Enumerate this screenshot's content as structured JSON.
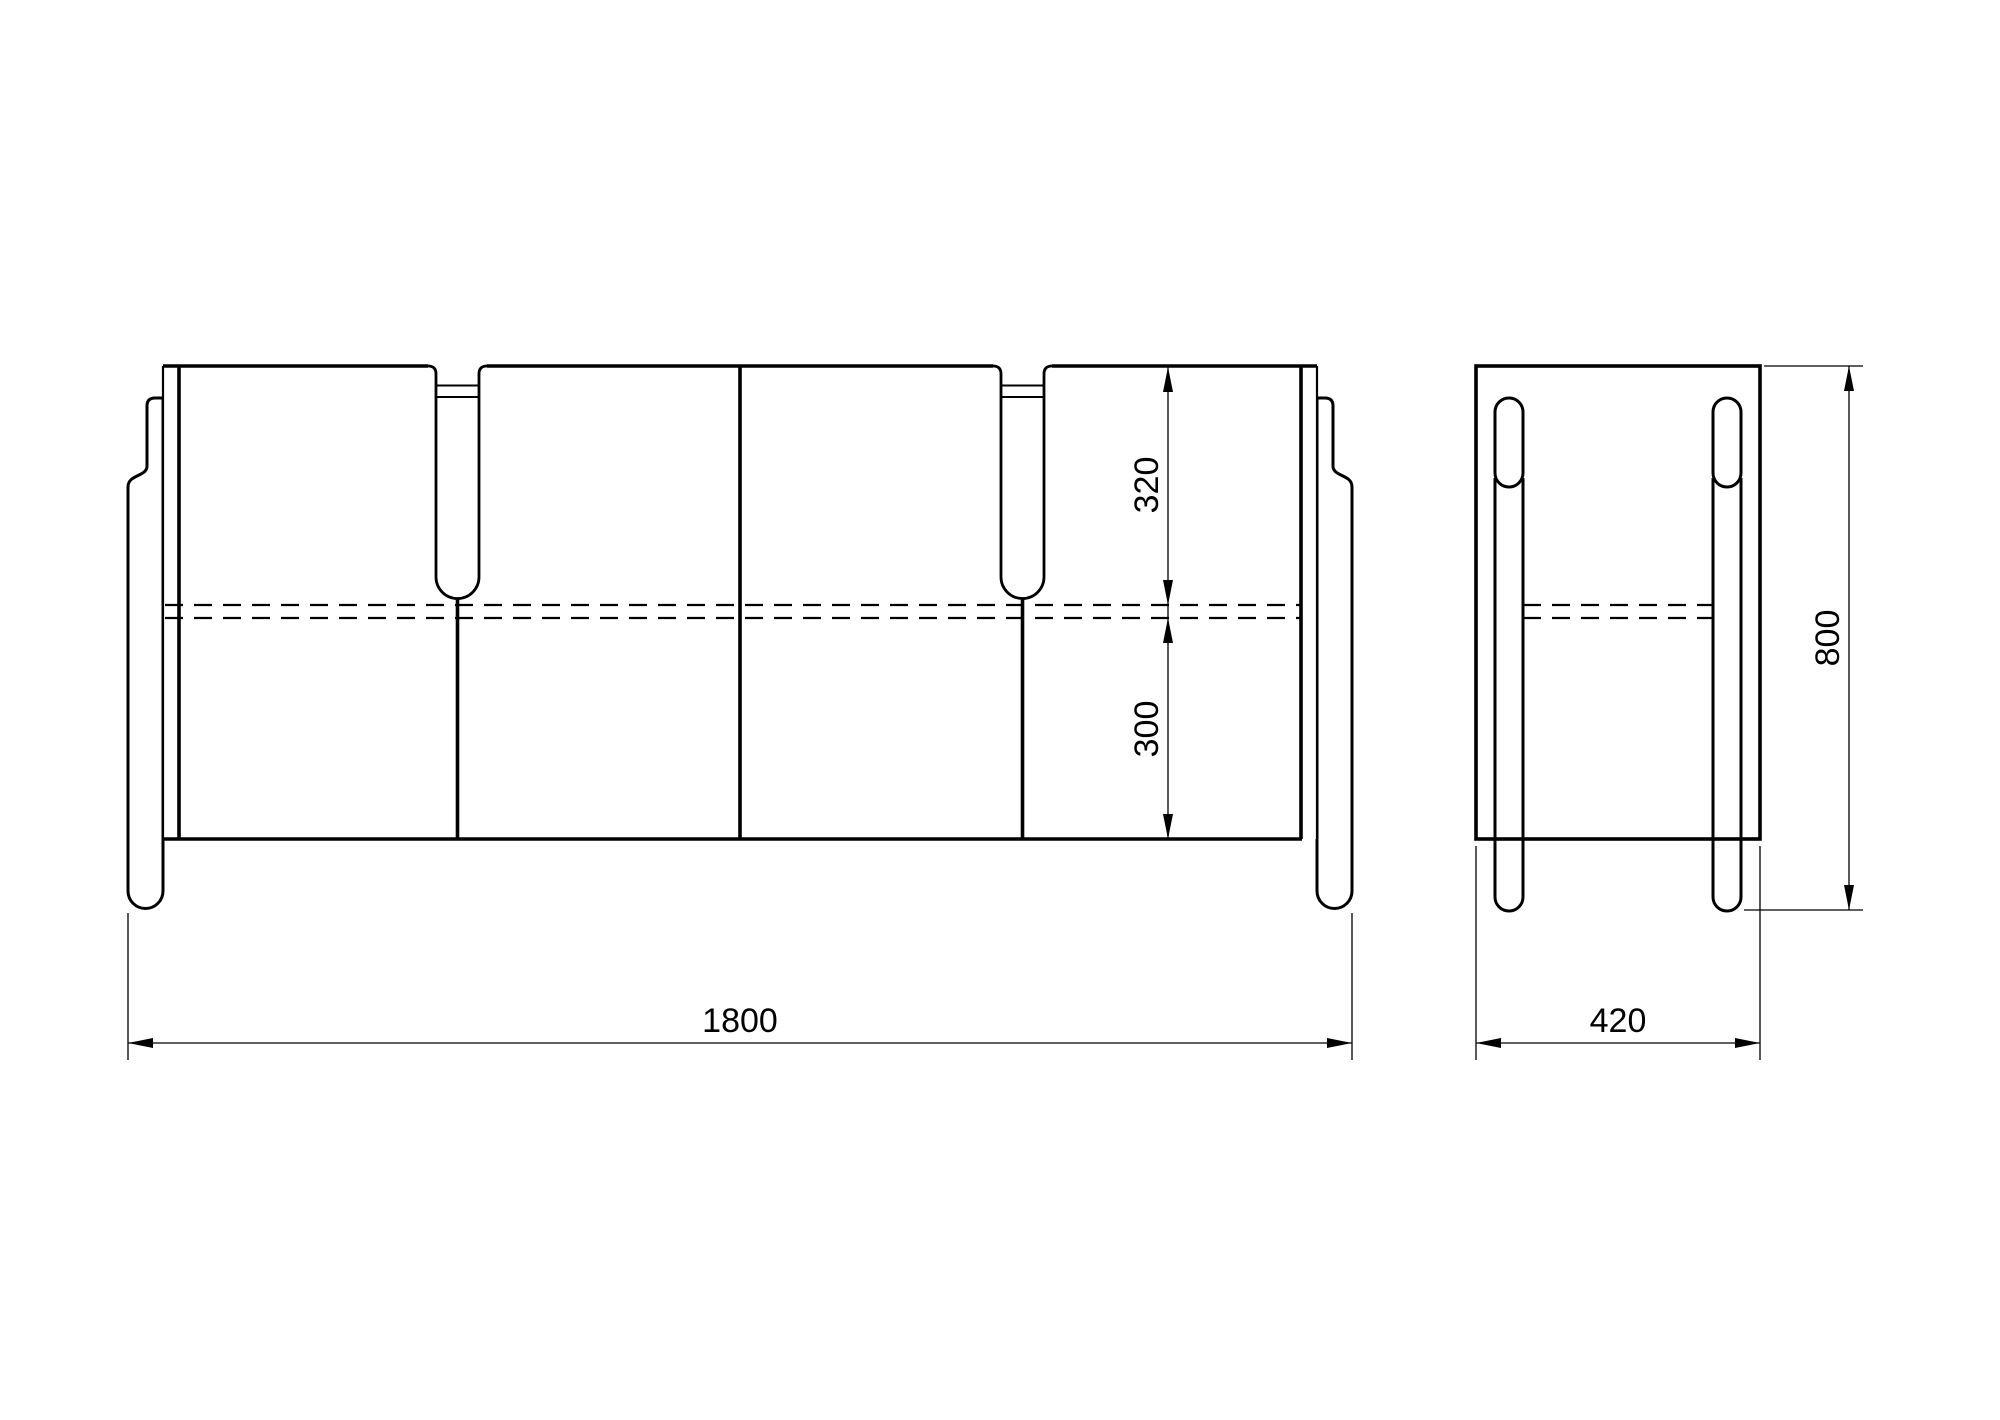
{
  "drawing": {
    "title": "sideboard-technical-drawing",
    "description": "Black and white CAD elevation drawing of a four-door sideboard on round legs: front view (left) and side view (right), with millimetre dimensions.",
    "colors": {
      "line": "#000000",
      "background": "#ffffff"
    },
    "front_view": {
      "doors": 4,
      "handle_slots": 2,
      "shelf_line_style": "dashed-hidden-edge"
    },
    "side_view": {
      "legs_visible": 2,
      "shelf_line_style": "dashed-hidden-edge"
    },
    "dimensions": {
      "overall_width": "1800",
      "overall_depth": "420",
      "overall_height": "800",
      "top_to_shelf": "320",
      "shelf_to_bottom": "300"
    }
  }
}
